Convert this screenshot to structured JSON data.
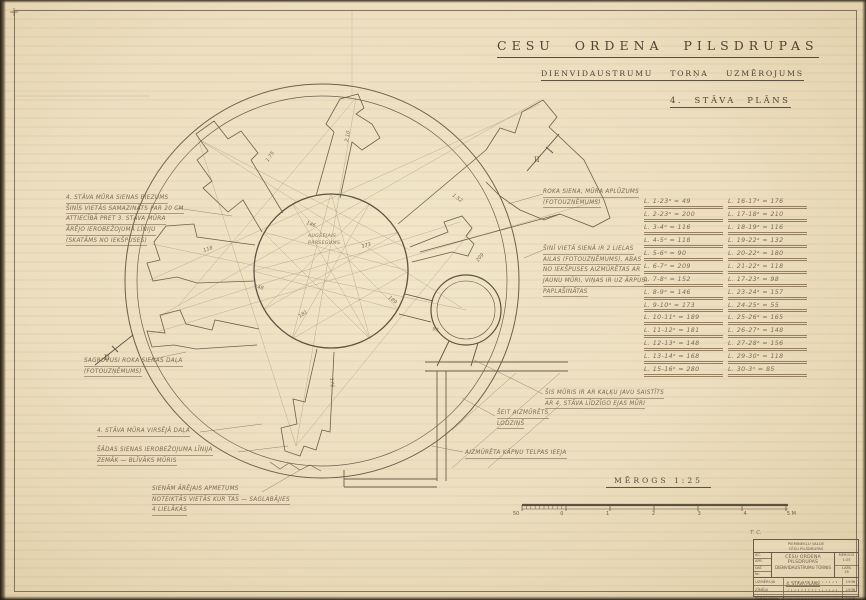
{
  "header": {
    "title": "CESU ORDENA PILSDRUPAS",
    "subtitle": "DIENVIDAUSTRUMU TORŅA UZMĒROJUMS",
    "sheet_title": "4. STĀVA PLĀNS"
  },
  "plan": {
    "center_label_line1": "AUGŠĒJAIS",
    "center_label_line2": "PĀRSEGUMS",
    "section_marker": "II",
    "measures": [
      "1.75",
      "2.10",
      "1.52",
      "146",
      "173",
      "189",
      "181",
      "148",
      "176",
      "96",
      "118",
      "209"
    ]
  },
  "annotations": {
    "wall_thickness": {
      "lines": [
        "4. STĀVA MŪRA SIENAS BIEZUMS",
        "ŠINĪS VIETĀS SAMAZINĀTS PAR 20 CM",
        "ATTIECĪBĀ PRET 3. STĀVA MŪRA",
        "ĀRĒJO IEROBEŽOJUMA LĪNIJU",
        "(SKATĀMS NO IEKŠPUSES)"
      ]
    },
    "broken_wall": {
      "lines": [
        "ROKA SIENA, MŪRA APLŪZUMS",
        "(FOTOUZŅĒMUMS)"
      ]
    },
    "two_openings": {
      "lines": [
        "ŠINĪ VIETĀ SIENĀ IR 2 LIELAS",
        "AILAS (FOTOUZŅĒMUMS), ABAS",
        "NO IEKŠPUSES AIZMŪRĒTAS AR",
        "JAUNU MŪRI, VIŅAS IR UZ ĀRPUSI",
        "PAPLAŠINĀTAS"
      ]
    },
    "collapsed_part": {
      "lines": [
        "SAGRUVUSI ROKA SIENAS DAĻA",
        "(FOTOUZŅĒMUMS)"
      ]
    },
    "upper_wall": {
      "lines": [
        "4. STĀVA MŪRA VIRSĒJĀ DAĻA"
      ]
    },
    "wall_line": {
      "lines": [
        "ŠĀDAS SIENAS IEROBEŽOJUMA LĪNIJA",
        "ZEMĀK — BLĪVĀKS MŪRIS"
      ]
    },
    "plaster": {
      "lines": [
        "SIENĀM ĀRĒJAIS APMETUMS",
        "NOTEIKTĀS VIETĀS KUR TAS — SAGLABĀJIES",
        "4 LIELĀKĀS"
      ]
    },
    "lime_wall": {
      "lines": [
        "ŠIS MŪRIS IR AR KAĻĶU JAVU SAISTĪTS",
        "AR 4. STĀVA LĪDZĪGO EJAS MŪRI"
      ]
    },
    "walled_window": {
      "lines": [
        "ŠEIT AIZMŪRĒTS",
        "LODZIŅŠ"
      ]
    },
    "walled_entry": {
      "lines": [
        "AIZMŪRĒTA KĀPŅU TELPAS IEEJA"
      ]
    }
  },
  "table": {
    "left": [
      "L. 1-23ᵃ = 49",
      "L. 2-23ᵃ = 200",
      "L. 3-4ᵃ = 116",
      "L. 4-5ᵃ = 118",
      "L. 5-6ᵃ = 90",
      "L. 6-7ᵃ = 209",
      "L. 7-8ᵃ = 152",
      "L. 8-9ᵃ = 146",
      "L. 9-10ᵃ = 173",
      "L. 10-11ᵃ = 189",
      "L. 11-12ᵃ = 181",
      "L. 12-13ᵃ = 148",
      "L. 13-14ᵃ = 168",
      "L. 15-16ᵃ = 280"
    ],
    "right": [
      "L. 16-17ᵃ = 176",
      "L. 17-18ᵃ = 210",
      "L. 18-19ᵃ = 116",
      "L. 19-22ᵃ = 132",
      "L. 20-22ᵃ = 180",
      "L. 21-22ᵃ = 118",
      "L. 17-23ᵃ = 98",
      "L. 23-24ᵃ = 157",
      "L. 24-25ᵃ = 55",
      "L. 25-26ᵃ = 165",
      "L. 26-27ᵃ = 148",
      "L. 27-28ᵃ = 156",
      "L. 29-30ᵃ = 118",
      "L. 30-3ᵃ = 85"
    ]
  },
  "scale": {
    "heading": "MĒROGS 1:25",
    "ticks": [
      "50",
      "0",
      "1",
      "2",
      "3",
      "4",
      "5 M"
    ]
  },
  "title_block": {
    "corner_mark": "T. C.",
    "org_line1": "PIEMINEKĻU VALDE",
    "org_line2": "CĒSU PILSDRUPAS",
    "title1": "CĒSU ORDEŅA PILSDRUPAS",
    "title2": "DIENVIDAUSTRUMU TORNIS",
    "title3": "4. STĀVA PLĀNS",
    "side_labels": [
      "IEC.",
      "APR.",
      "DAT.",
      "Nr."
    ],
    "rows": [
      {
        "label": "UZMĒROJA",
        "year": "1936"
      },
      {
        "label": "ZĪMĒJA",
        "year": "1936"
      },
      {
        "label": "PĀRBAUDĪJA",
        "year": "1936"
      }
    ],
    "scale_label": "MĒROGS",
    "scale_value": "1:25",
    "sheet_label": "LAPA",
    "sheet_value": "16"
  }
}
